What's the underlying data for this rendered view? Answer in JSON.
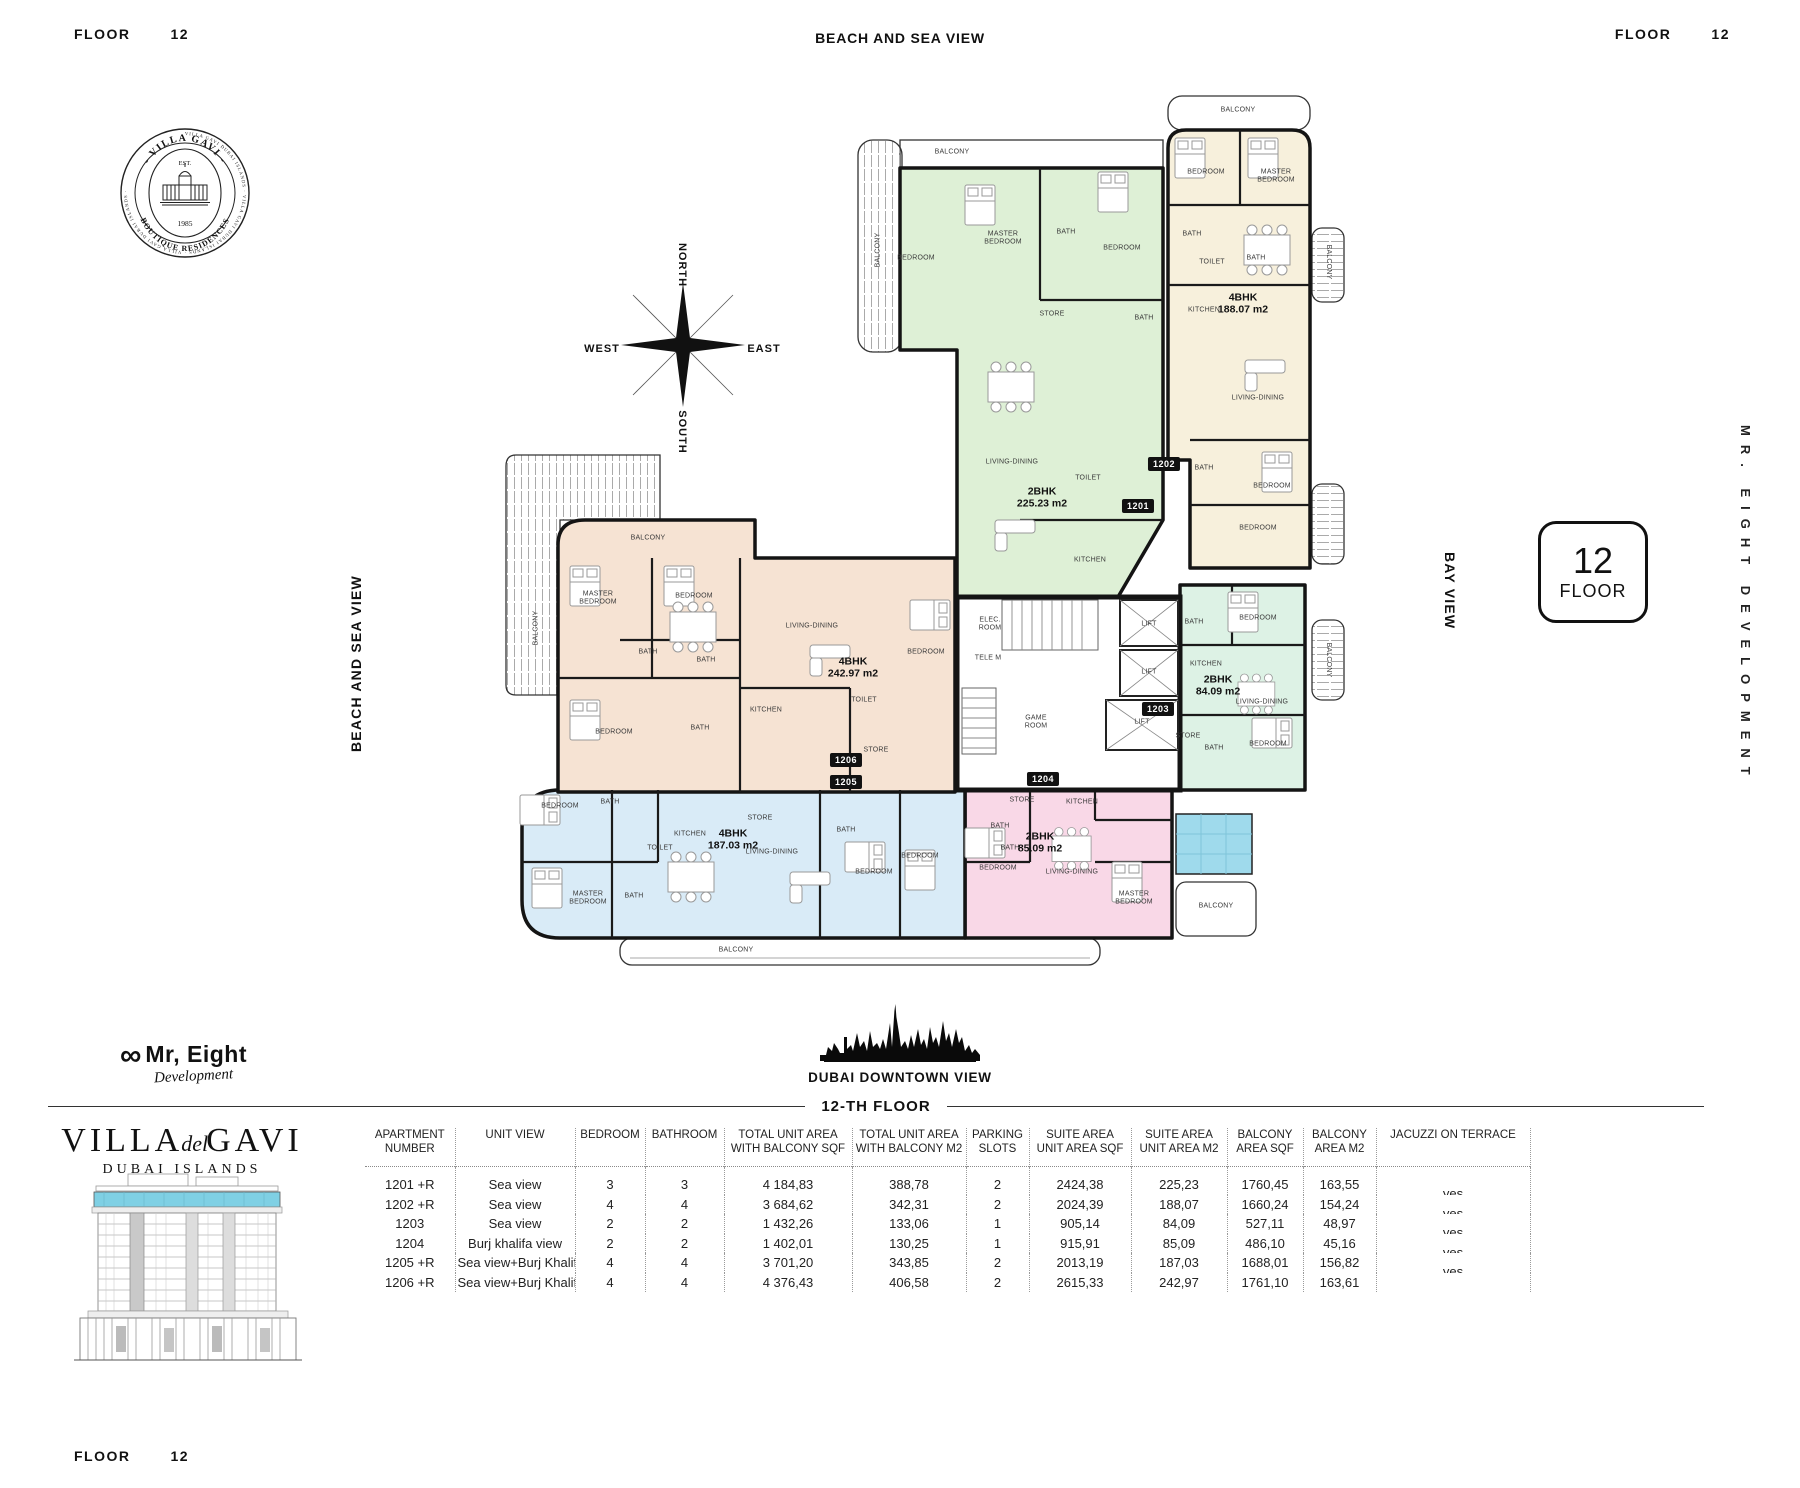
{
  "header": {
    "floor_label": "FLOOR",
    "floor_number": "12",
    "view_label": "BEACH AND SEA VIEW"
  },
  "footer_corner": {
    "floor_label": "FLOOR",
    "floor_number": "12"
  },
  "side": {
    "left": "BEACH AND SEA VIEW",
    "bay": "BAY VIEW",
    "developer": "MR. EIGHT DEVELOPMENT"
  },
  "badge": {
    "number": "12",
    "label": "FLOOR"
  },
  "compass": {
    "north": "NORTH",
    "south": "SOUTH",
    "east": "EAST",
    "west": "WEST"
  },
  "stamp": {
    "ring": "VILLA GAVI DUBAI ISLANDS · VILLA GAVI DUBAI ISLANDS · VILLA GAVI DUBAI ISLANDS ·",
    "arc_top": "- VILLA GAVI -",
    "arc_bottom": "BOUTIQUE RESIDENCES",
    "est": "EST.",
    "year": "1985"
  },
  "developer_logo": {
    "infinity": "∞",
    "name": "Mr, Eight",
    "tagline": "Development"
  },
  "skyline": {
    "caption": "DUBAI DOWNTOWN VIEW"
  },
  "divider": {
    "label": "12-TH FLOOR"
  },
  "brand": {
    "line1": "VILLA",
    "script": "del",
    "line2": "GAVI",
    "subtitle": "DUBAI ISLANDS"
  },
  "plan": {
    "wall_color": "#141414",
    "pool_color": "#9fdaec",
    "units": [
      {
        "number": "1201",
        "type_label": "2BHK",
        "area_label": "225.23 m2",
        "color": "#def0d6",
        "label_x": 1042,
        "label_y": 498,
        "tag_x": 1138,
        "tag_y": 506
      },
      {
        "number": "1202",
        "type_label": "4BHK",
        "area_label": "188.07 m2",
        "color": "#f7f0dc",
        "label_x": 1243,
        "label_y": 304,
        "tag_x": 1164,
        "tag_y": 464
      },
      {
        "number": "1203",
        "type_label": "2BHK",
        "area_label": "84.09 m2",
        "color": "#ddf2e5",
        "label_x": 1218,
        "label_y": 686,
        "tag_x": 1158,
        "tag_y": 709
      },
      {
        "number": "1204",
        "type_label": "2BHK",
        "area_label": "85.09 m2",
        "color": "#f9d8e7",
        "label_x": 1040,
        "label_y": 843,
        "tag_x": 1043,
        "tag_y": 779
      },
      {
        "number": "1205",
        "type_label": "4BHK",
        "area_label": "187.03 m2",
        "color": "#d9ebf7",
        "label_x": 733,
        "label_y": 840,
        "tag_x": 846,
        "tag_y": 782
      },
      {
        "number": "1206",
        "type_label": "4BHK",
        "area_label": "242.97 m2",
        "color": "#f6e3d3",
        "label_x": 853,
        "label_y": 668,
        "tag_x": 846,
        "tag_y": 760
      }
    ],
    "room_labels": [
      {
        "t": "MASTER\nBEDROOM",
        "x": 1003,
        "y": 238
      },
      {
        "t": "BEDROOM",
        "x": 916,
        "y": 258
      },
      {
        "t": "BATH",
        "x": 1066,
        "y": 232
      },
      {
        "t": "BEDROOM",
        "x": 1122,
        "y": 248
      },
      {
        "t": "BATH",
        "x": 1144,
        "y": 318
      },
      {
        "t": "STORE",
        "x": 1052,
        "y": 314
      },
      {
        "t": "LIVING-DINING",
        "x": 1012,
        "y": 462
      },
      {
        "t": "TOILET",
        "x": 1088,
        "y": 478
      },
      {
        "t": "KITCHEN",
        "x": 1090,
        "y": 560
      },
      {
        "t": "BALCONY",
        "x": 952,
        "y": 152
      },
      {
        "t": "BALCONY",
        "x": 878,
        "y": 250,
        "r": -90
      },
      {
        "t": "BEDROOM",
        "x": 1206,
        "y": 172
      },
      {
        "t": "MASTER\nBEDROOM",
        "x": 1276,
        "y": 176
      },
      {
        "t": "BATH",
        "x": 1192,
        "y": 234
      },
      {
        "t": "TOILET",
        "x": 1212,
        "y": 262
      },
      {
        "t": "BATH",
        "x": 1256,
        "y": 258
      },
      {
        "t": "KITCHEN",
        "x": 1204,
        "y": 310
      },
      {
        "t": "LIVING-DINING",
        "x": 1258,
        "y": 398
      },
      {
        "t": "BATH",
        "x": 1204,
        "y": 468
      },
      {
        "t": "BEDROOM",
        "x": 1272,
        "y": 486
      },
      {
        "t": "BEDROOM",
        "x": 1258,
        "y": 528
      },
      {
        "t": "BALCONY",
        "x": 1238,
        "y": 110
      },
      {
        "t": "BALCONY",
        "x": 1328,
        "y": 262,
        "r": 90
      },
      {
        "t": "BATH",
        "x": 1194,
        "y": 622
      },
      {
        "t": "BEDROOM",
        "x": 1258,
        "y": 618
      },
      {
        "t": "KITCHEN",
        "x": 1206,
        "y": 664
      },
      {
        "t": "LIVING-DINING",
        "x": 1262,
        "y": 702
      },
      {
        "t": "STORE",
        "x": 1188,
        "y": 736
      },
      {
        "t": "BATH",
        "x": 1214,
        "y": 748
      },
      {
        "t": "BEDROOM",
        "x": 1268,
        "y": 744
      },
      {
        "t": "BALCONY",
        "x": 1328,
        "y": 660,
        "r": 90
      },
      {
        "t": "MASTER\nBEDROOM",
        "x": 598,
        "y": 598
      },
      {
        "t": "BEDROOM",
        "x": 694,
        "y": 596
      },
      {
        "t": "BATH",
        "x": 648,
        "y": 652
      },
      {
        "t": "BATH",
        "x": 706,
        "y": 660
      },
      {
        "t": "LIVING-DINING",
        "x": 812,
        "y": 626
      },
      {
        "t": "BEDROOM",
        "x": 926,
        "y": 652
      },
      {
        "t": "KITCHEN",
        "x": 766,
        "y": 710
      },
      {
        "t": "BEDROOM",
        "x": 614,
        "y": 732
      },
      {
        "t": "BATH",
        "x": 700,
        "y": 728
      },
      {
        "t": "TOILET",
        "x": 864,
        "y": 700
      },
      {
        "t": "STORE",
        "x": 876,
        "y": 750
      },
      {
        "t": "BALCONY",
        "x": 648,
        "y": 538
      },
      {
        "t": "BALCONY",
        "x": 536,
        "y": 628,
        "r": -90
      },
      {
        "t": "BEDROOM",
        "x": 560,
        "y": 806
      },
      {
        "t": "BATH",
        "x": 610,
        "y": 802
      },
      {
        "t": "KITCHEN",
        "x": 690,
        "y": 834
      },
      {
        "t": "TOILET",
        "x": 660,
        "y": 848
      },
      {
        "t": "STORE",
        "x": 760,
        "y": 818
      },
      {
        "t": "LIVING-DINING",
        "x": 772,
        "y": 852
      },
      {
        "t": "BATH",
        "x": 846,
        "y": 830
      },
      {
        "t": "BEDROOM",
        "x": 874,
        "y": 872
      },
      {
        "t": "BEDROOM",
        "x": 920,
        "y": 856
      },
      {
        "t": "MASTER\nBEDROOM",
        "x": 588,
        "y": 898
      },
      {
        "t": "BATH",
        "x": 634,
        "y": 896
      },
      {
        "t": "BALCONY",
        "x": 736,
        "y": 950
      },
      {
        "t": "STORE",
        "x": 1022,
        "y": 800
      },
      {
        "t": "KITCHEN",
        "x": 1082,
        "y": 802
      },
      {
        "t": "BATH",
        "x": 1000,
        "y": 826
      },
      {
        "t": "BATH",
        "x": 1010,
        "y": 848
      },
      {
        "t": "BEDROOM",
        "x": 998,
        "y": 868
      },
      {
        "t": "LIVING-DINING",
        "x": 1072,
        "y": 872
      },
      {
        "t": "MASTER\nBEDROOM",
        "x": 1134,
        "y": 898
      },
      {
        "t": "BALCONY",
        "x": 1216,
        "y": 906
      },
      {
        "t": "ELEC.\nROOM",
        "x": 990,
        "y": 624
      },
      {
        "t": "TELE M",
        "x": 988,
        "y": 658
      },
      {
        "t": "LIFT",
        "x": 1149,
        "y": 624
      },
      {
        "t": "LIFT",
        "x": 1149,
        "y": 672
      },
      {
        "t": "LIFT",
        "x": 1142,
        "y": 722
      },
      {
        "t": "GAME\nROOM",
        "x": 1036,
        "y": 722
      }
    ]
  },
  "table": {
    "headers": [
      "APARTMENT\nNUMBER",
      "UNIT VIEW",
      "BEDROOM",
      "BATHROOM",
      "TOTAL UNIT AREA\nWITH BALCONY SQF",
      "TOTAL  UNIT AREA\nWITH BALCONY M2",
      "PARKING\nSLOTS",
      "SUITE AREA\nUNIT AREA SQF",
      "SUITE AREA\nUNIT AREA M2",
      "BALCONY\nAREA SQF",
      "BALCONY\nAREA M2",
      "JACUZZI ON TERRACE"
    ],
    "rows": [
      [
        "1201 +R",
        "Sea view",
        "3",
        "3",
        "4 184,83",
        "388,78",
        "2",
        "2424,38",
        "225,23",
        "1760,45",
        "163,55",
        "yes"
      ],
      [
        "1202 +R",
        "Sea view",
        "4",
        "4",
        "3 684,62",
        "342,31",
        "2",
        "2024,39",
        "188,07",
        "1660,24",
        "154,24",
        "yes"
      ],
      [
        "1203",
        "Sea view",
        "2",
        "2",
        "1 432,26",
        "133,06",
        "1",
        "905,14",
        "84,09",
        "527,11",
        "48,97",
        "yes"
      ],
      [
        "1204",
        "Burj khalifa view",
        "2",
        "2",
        "1 402,01",
        "130,25",
        "1",
        "915,91",
        "85,09",
        "486,10",
        "45,16",
        "yes"
      ],
      [
        "1205 +R",
        "Sea view+Burj Khalifa",
        "4",
        "4",
        "3 701,20",
        "343,85",
        "2",
        "2013,19",
        "187,03",
        "1688,01",
        "156,82",
        "yes"
      ],
      [
        "1206 +R",
        "Sea view+Burj Khalifa",
        "4",
        "4",
        "4 376,43",
        "406,58",
        "2",
        "2615,33",
        "242,97",
        "1761,10",
        "163,61",
        ""
      ]
    ]
  }
}
